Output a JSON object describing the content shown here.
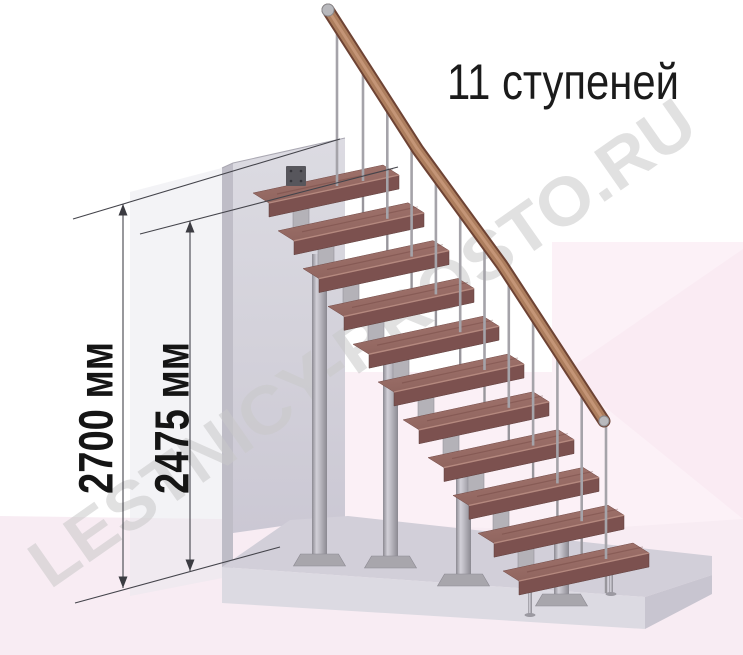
{
  "title": "11 ступеней",
  "watermark": "LESTNICY-PROSTO.RU",
  "dimensions": {
    "floor_to_floor": "2700 мм",
    "floor_to_top_step": "2475 мм"
  },
  "scene": {
    "step_count": 11,
    "colors": {
      "tread_top_a": "#a4766f",
      "tread_top_b": "#8f645e",
      "tread_front": "#7c514f",
      "tread_side": "#8a5a55",
      "tread_edge_highlight": "#b5897f",
      "handrail_dark": "#6e4334",
      "handrail_mid": "#ad7e5e",
      "handrail_light": "#c8997b",
      "rail_cap_metal": "#b9b9bd",
      "baluster": "#a5a3a9",
      "baluster_stub": "#98969c",
      "connector_metal": "#b4b2b8",
      "connector_stroke": "#94929a",
      "column_edge": "#8b8991",
      "column_light": "#d2d0d8",
      "base_plate": "#a8a6ac",
      "foot": "#9b99a1",
      "bracket_plate": "#57565c",
      "bracket_hole": "#35343a",
      "wall_top": "#dcdbe2",
      "wall_mid": "#d3d1da",
      "wall_bottom": "#cbc8d4",
      "wall_side": "#bfbdc7",
      "wall_edge": "#aaa8b2",
      "platform_top": "#d2cfd9",
      "platform_front": "#dcdae2",
      "platform_right": "#c8c5d0",
      "pink_main": "#f8ecf3",
      "pink_right": "#fcf1f7",
      "pink_facet": "#faebf3",
      "pink_mid": "#fbf0f6",
      "second_wall": "#e8e7ee",
      "dimension_line": "#44444b",
      "arrow_fill": "#3c3c42",
      "label_text": "#151515",
      "title_text": "#1b1b1b",
      "watermark_gray": "#c9c9c9"
    }
  }
}
